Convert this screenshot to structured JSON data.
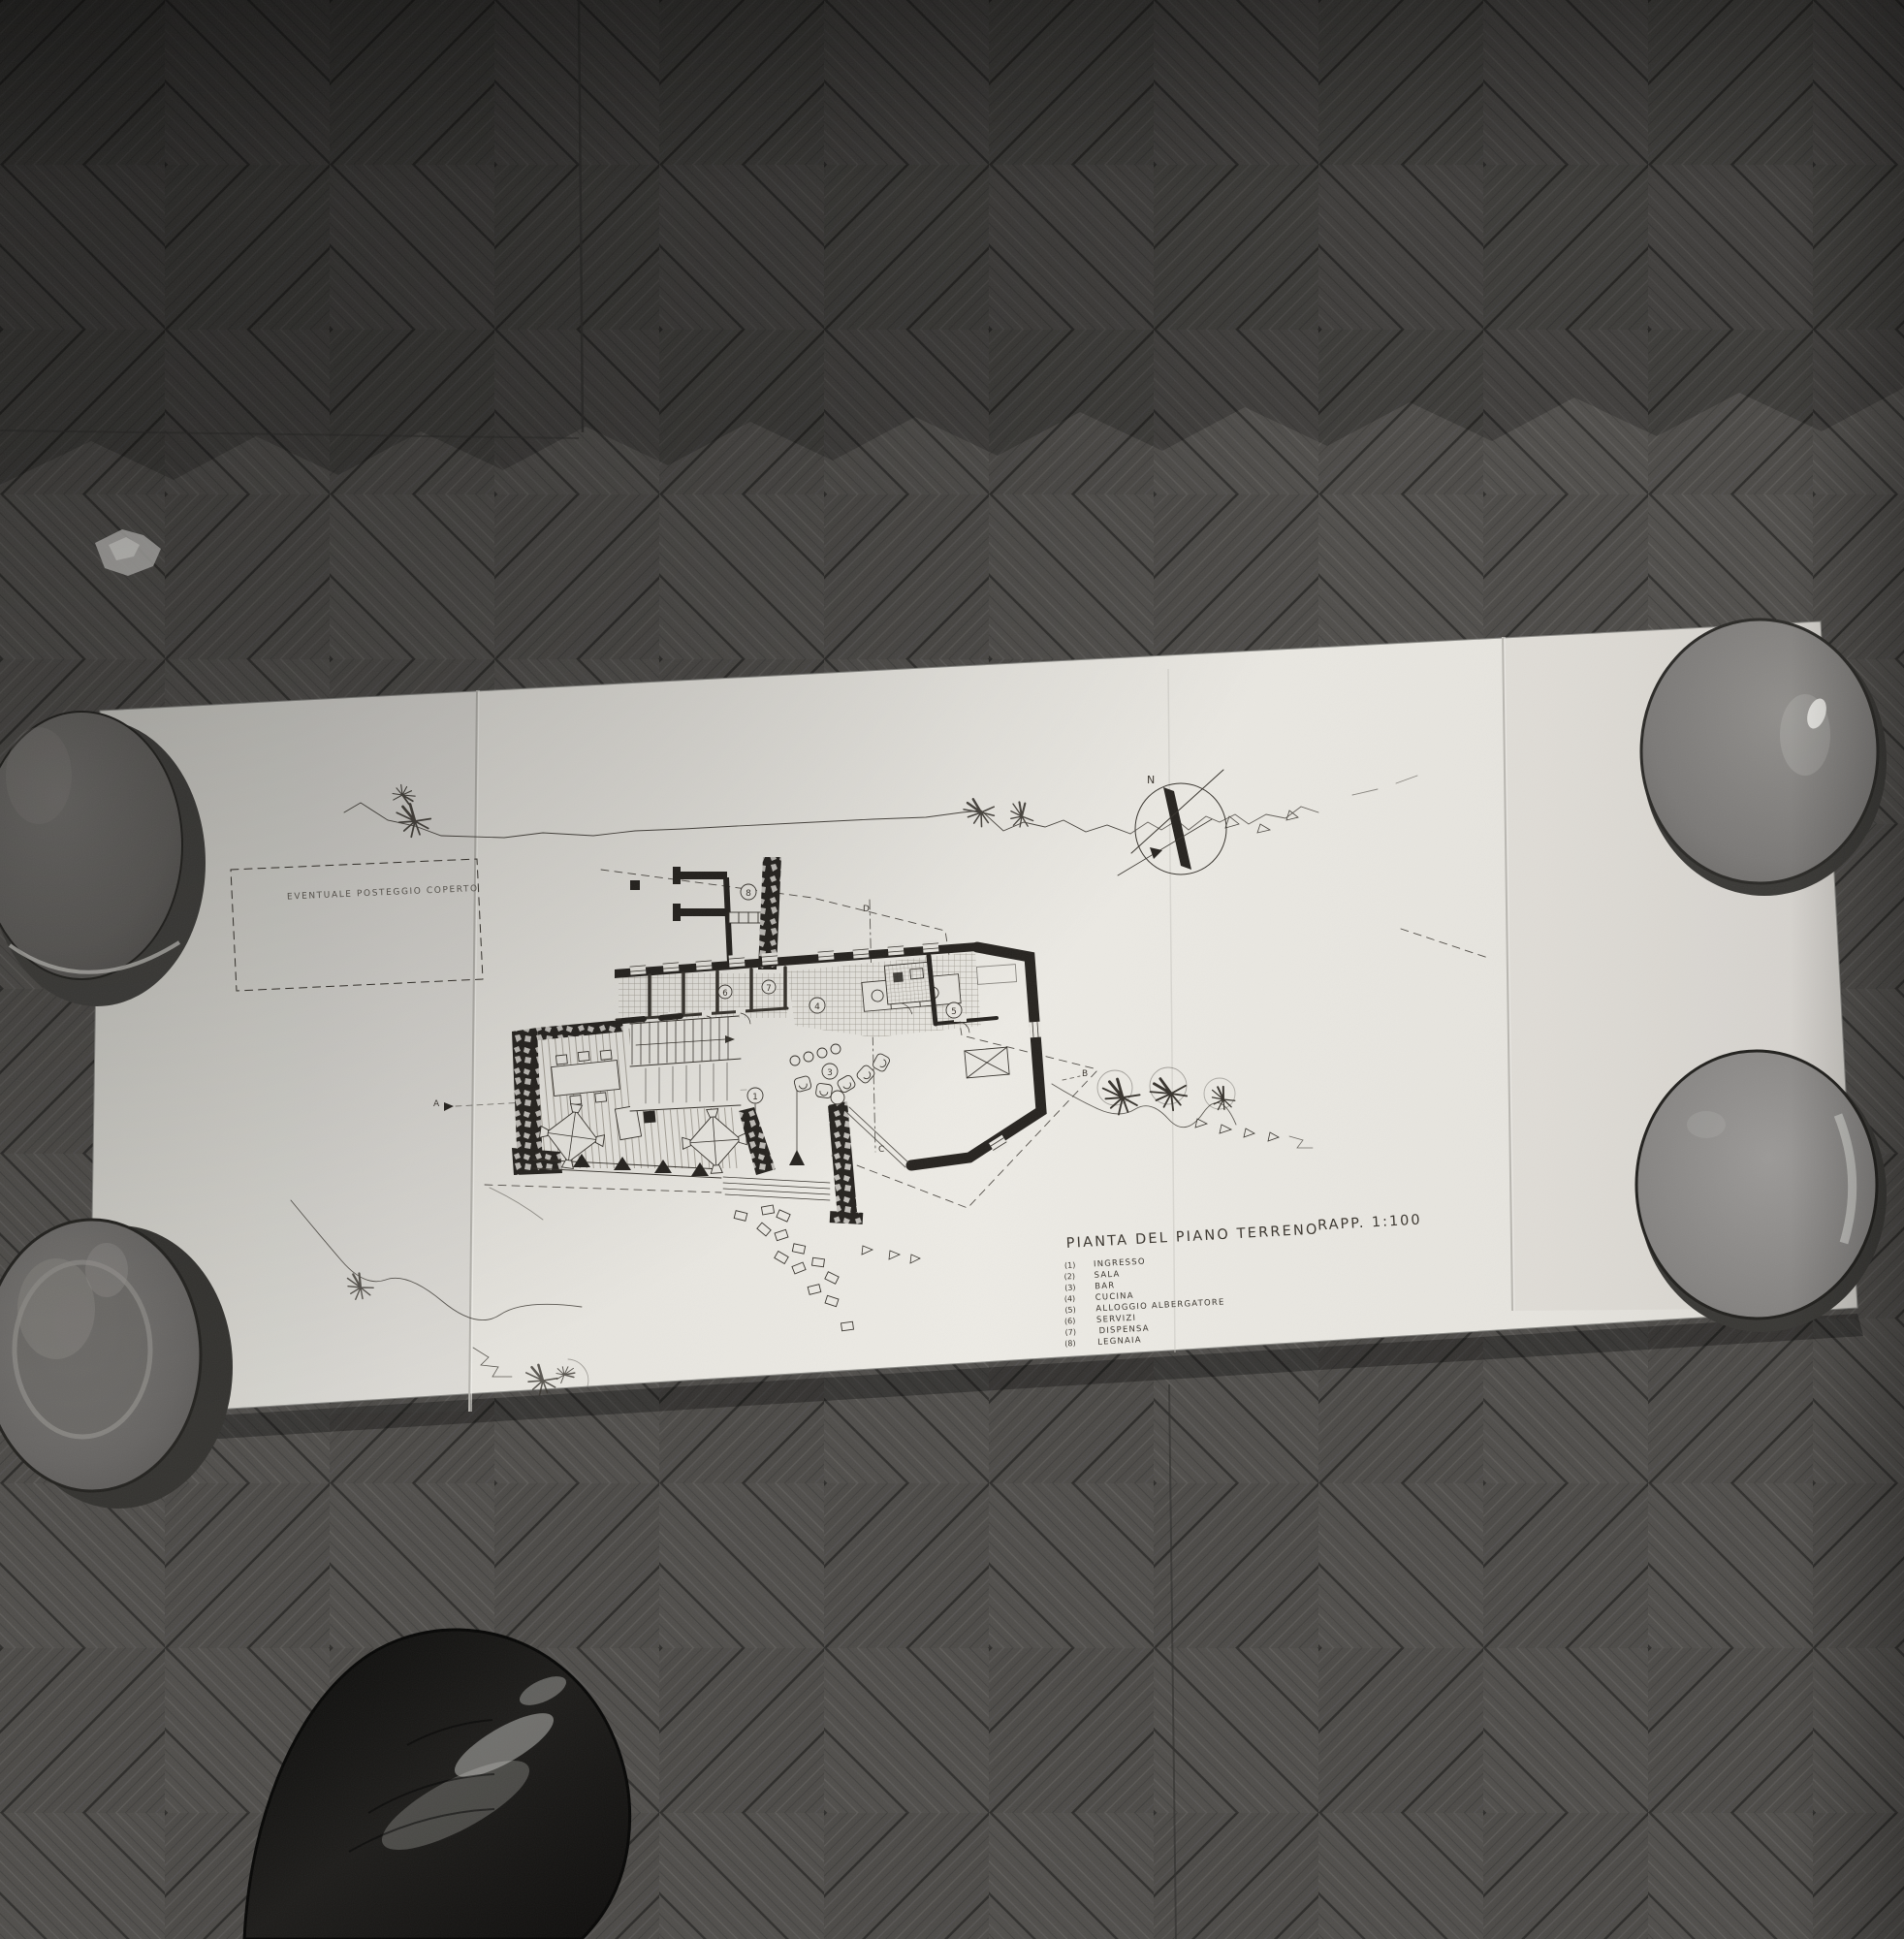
{
  "drawing": {
    "title": "PIANTA DEL PIANO TERRENO",
    "scale_label": "RAPP. 1:100",
    "site_annotation": "EVENTUALE POSTEGGIO COPERTO",
    "compass_label": "N",
    "sections": {
      "a": "A",
      "b": "B",
      "c": "C",
      "d": "D"
    },
    "legend": {
      "items": [
        {
          "digit": "1",
          "display": "(1)",
          "label": "INGRESSO"
        },
        {
          "digit": "2",
          "display": "(2)",
          "label": "SALA"
        },
        {
          "digit": "3",
          "display": "(3)",
          "label": "BAR"
        },
        {
          "digit": "4",
          "display": "(4)",
          "label": "CUCINA"
        },
        {
          "digit": "5",
          "display": "(5)",
          "label": "ALLOGGIO ALBERGATORE"
        },
        {
          "digit": "6",
          "display": "(6)",
          "label": "SERVIZI"
        },
        {
          "digit": "7",
          "display": "(7)",
          "label": "DISPENSA"
        },
        {
          "digit": "8",
          "display": "(8)",
          "label": "LEGNAIA"
        }
      ]
    }
  },
  "colors": {
    "floor_wood_dark": "#4c4a47",
    "paper": "#eae8e2",
    "ink": "#37332d",
    "bowl_gray": "#7b7977",
    "shoe_black": "#161513"
  }
}
